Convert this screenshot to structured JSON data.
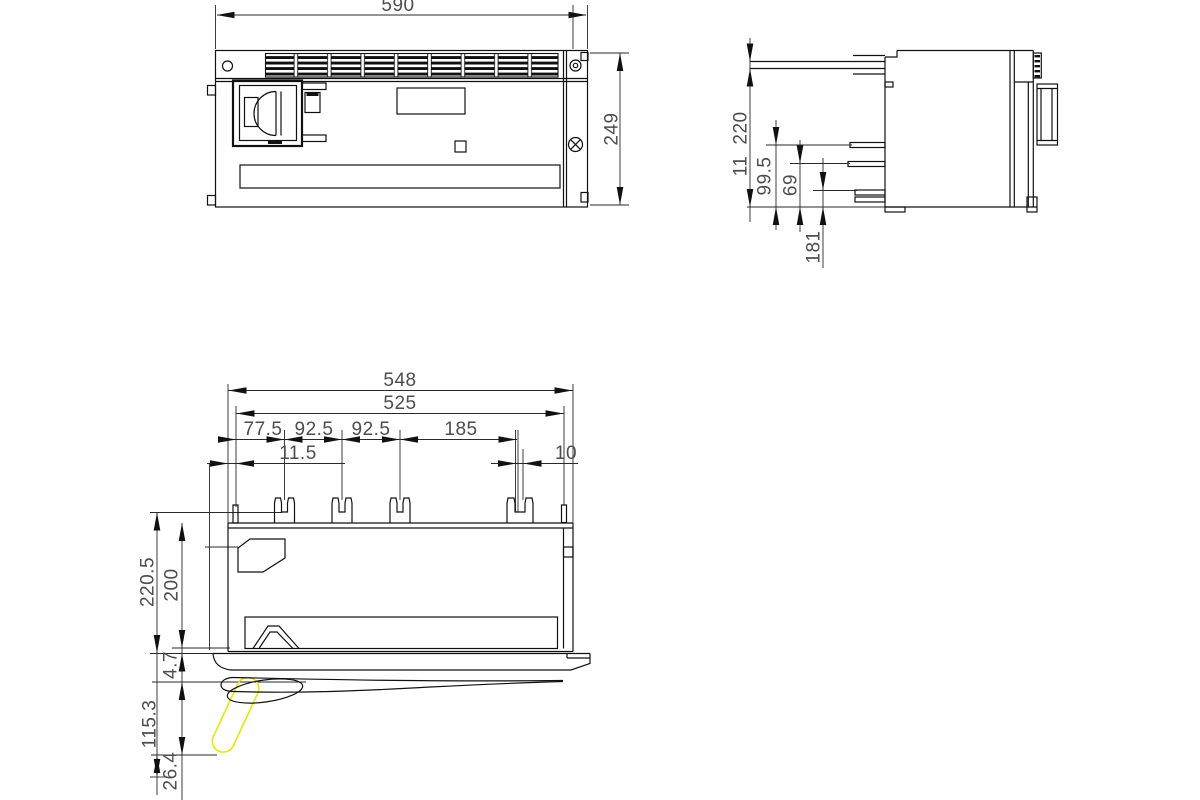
{
  "drawing": {
    "kind": "technical-dimension-drawing",
    "colors": {
      "line": "#111111",
      "dim_text": "#4d4d4d",
      "highlight": "#f2f200",
      "background": "#ffffff"
    },
    "dims": {
      "front": {
        "width": "590",
        "height": "249"
      },
      "side": {
        "overall_height": "220",
        "busbar_thickness": "11",
        "terminal1_height": "99.5",
        "terminal2_height": "69",
        "terminal3_height": "181"
      },
      "bottom": {
        "overall_width": "548",
        "inner_width": "525",
        "pitch1": "77.5",
        "pitch2": "92.5",
        "pitch3": "92.5",
        "pitch4": "185",
        "edge_offset": "11.5",
        "pole_offset": "10",
        "overall_height": "220.5",
        "body_height": "200",
        "plate_gap": "4.7",
        "lever_reach": "115.3",
        "lever_tip": "26.4"
      }
    }
  }
}
